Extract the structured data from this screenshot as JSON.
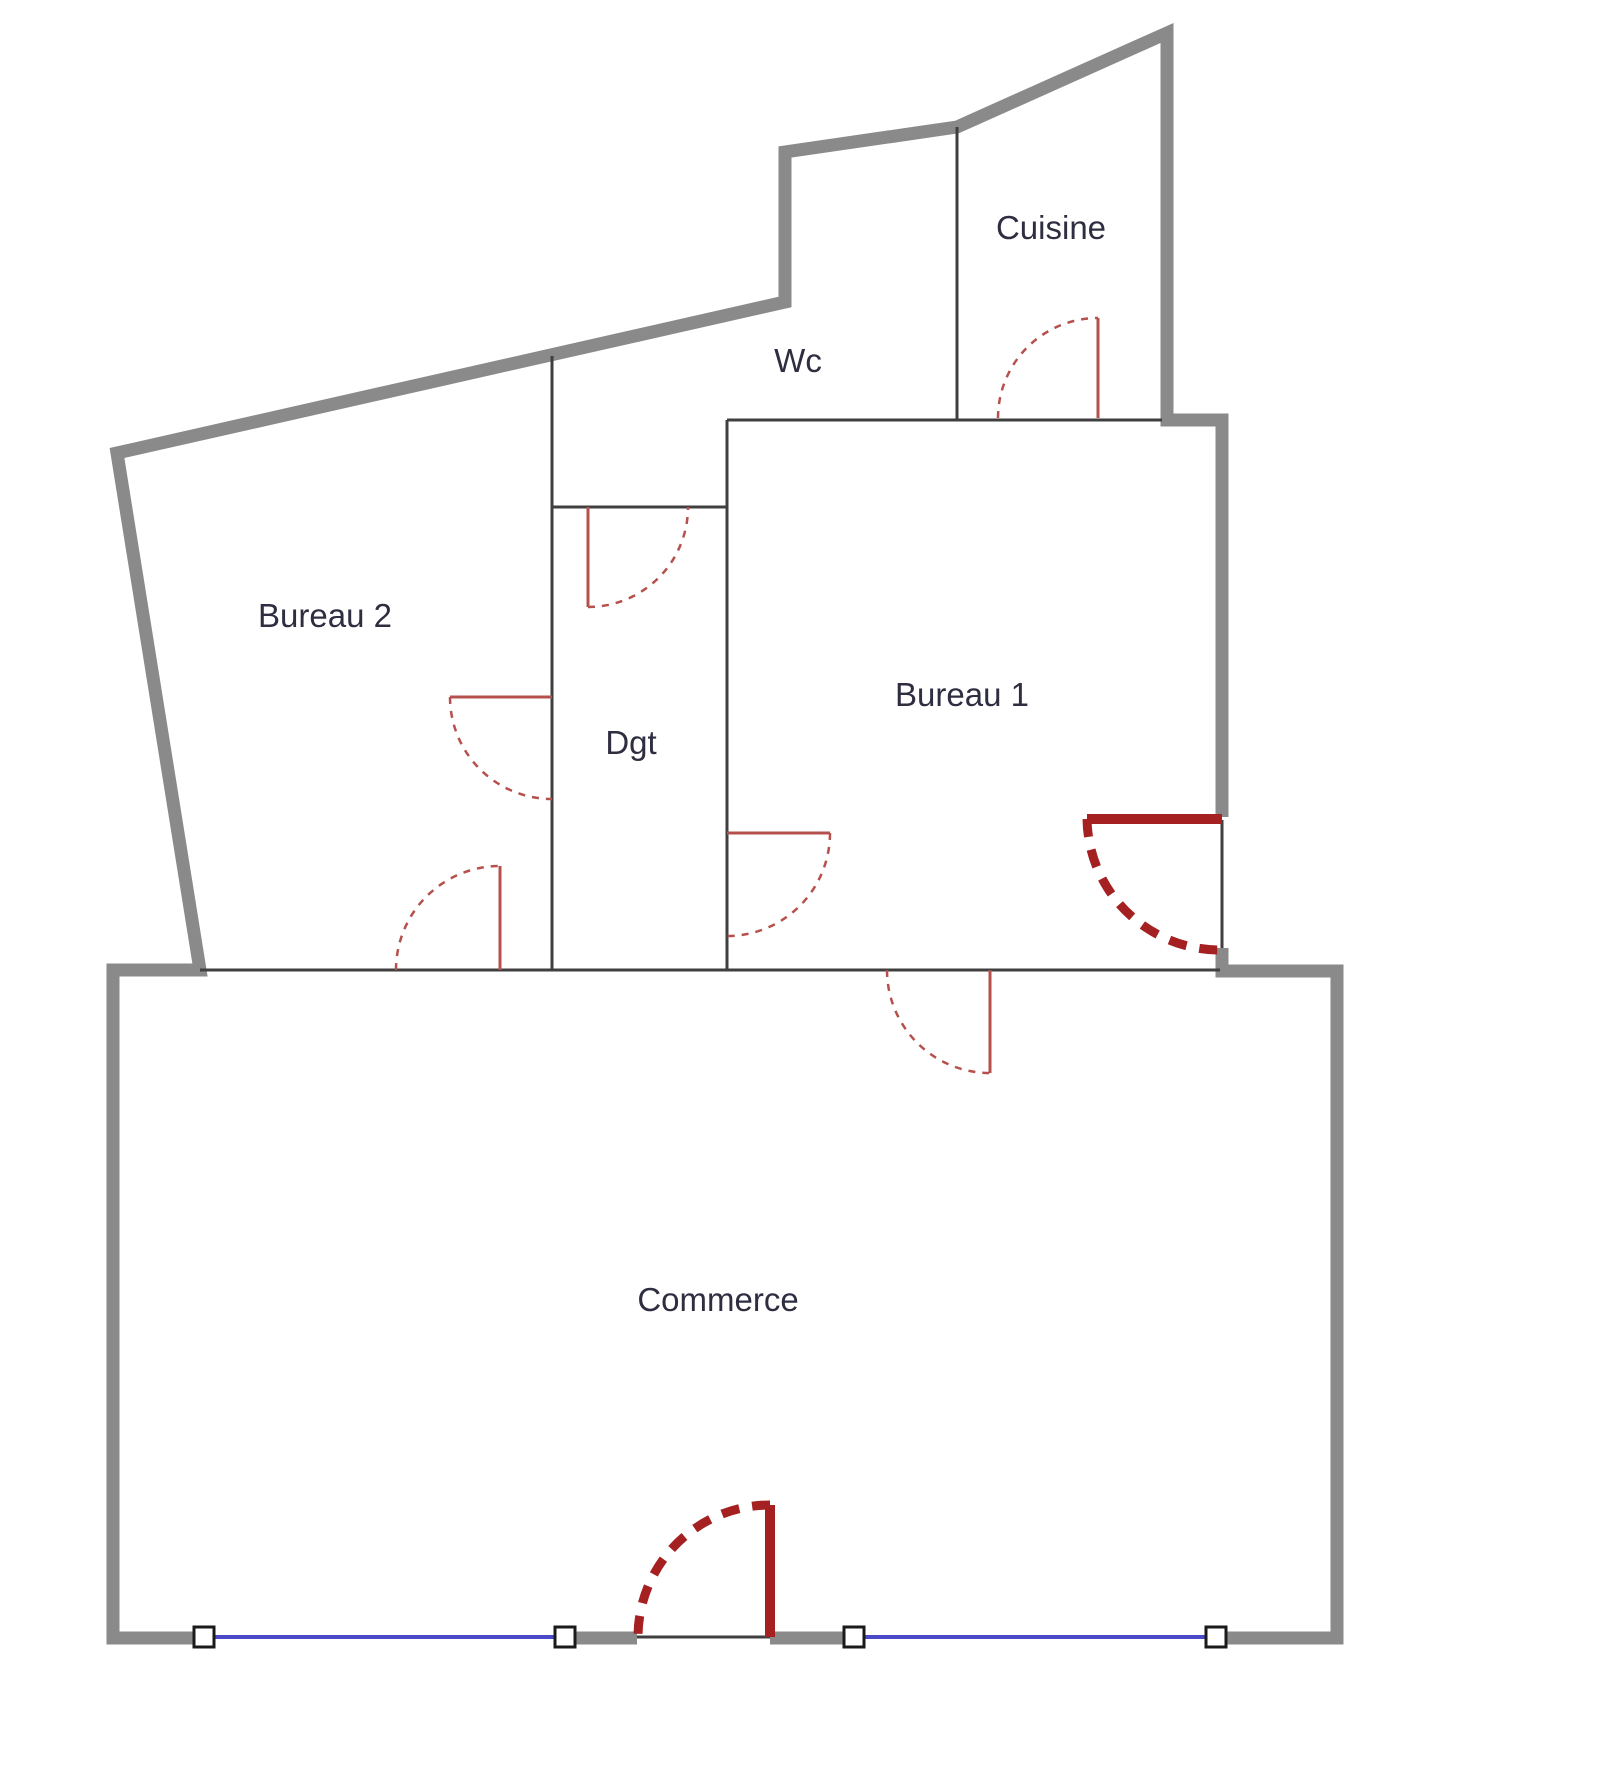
{
  "diagram": {
    "type": "floor-plan",
    "background": "#ffffff"
  },
  "colors": {
    "wall_gray": "#8a8a8a",
    "wall_thin": "#3f3f3f",
    "door_red": "#b5504d",
    "door_dark_red": "#a52121",
    "window_blue": "#4a4ac8",
    "marker_border": "#1a1a1a",
    "label_color": "#2e2e40",
    "background": "#ffffff"
  },
  "rooms": {
    "cuisine": {
      "label": "Cuisine"
    },
    "wc": {
      "label": "Wc"
    },
    "bureau2": {
      "label": "Bureau 2"
    },
    "dgt": {
      "label": "Dgt"
    },
    "bureau1": {
      "label": "Bureau 1"
    },
    "commerce": {
      "label": "Commerce"
    }
  },
  "doors": [
    {
      "name": "cuisine-door",
      "style": "interior"
    },
    {
      "name": "wc-door",
      "style": "interior"
    },
    {
      "name": "bureau2-dgt-door",
      "style": "interior"
    },
    {
      "name": "dgt-bureau1-door",
      "style": "interior"
    },
    {
      "name": "bureau2-commerce-door",
      "style": "interior"
    },
    {
      "name": "bureau1-commerce-door",
      "style": "interior"
    },
    {
      "name": "bureau1-entrance-door",
      "style": "main-entrance"
    },
    {
      "name": "commerce-entrance-door",
      "style": "main-entrance"
    }
  ],
  "windows": [
    {
      "name": "storefront-window-left"
    },
    {
      "name": "storefront-window-right"
    }
  ]
}
